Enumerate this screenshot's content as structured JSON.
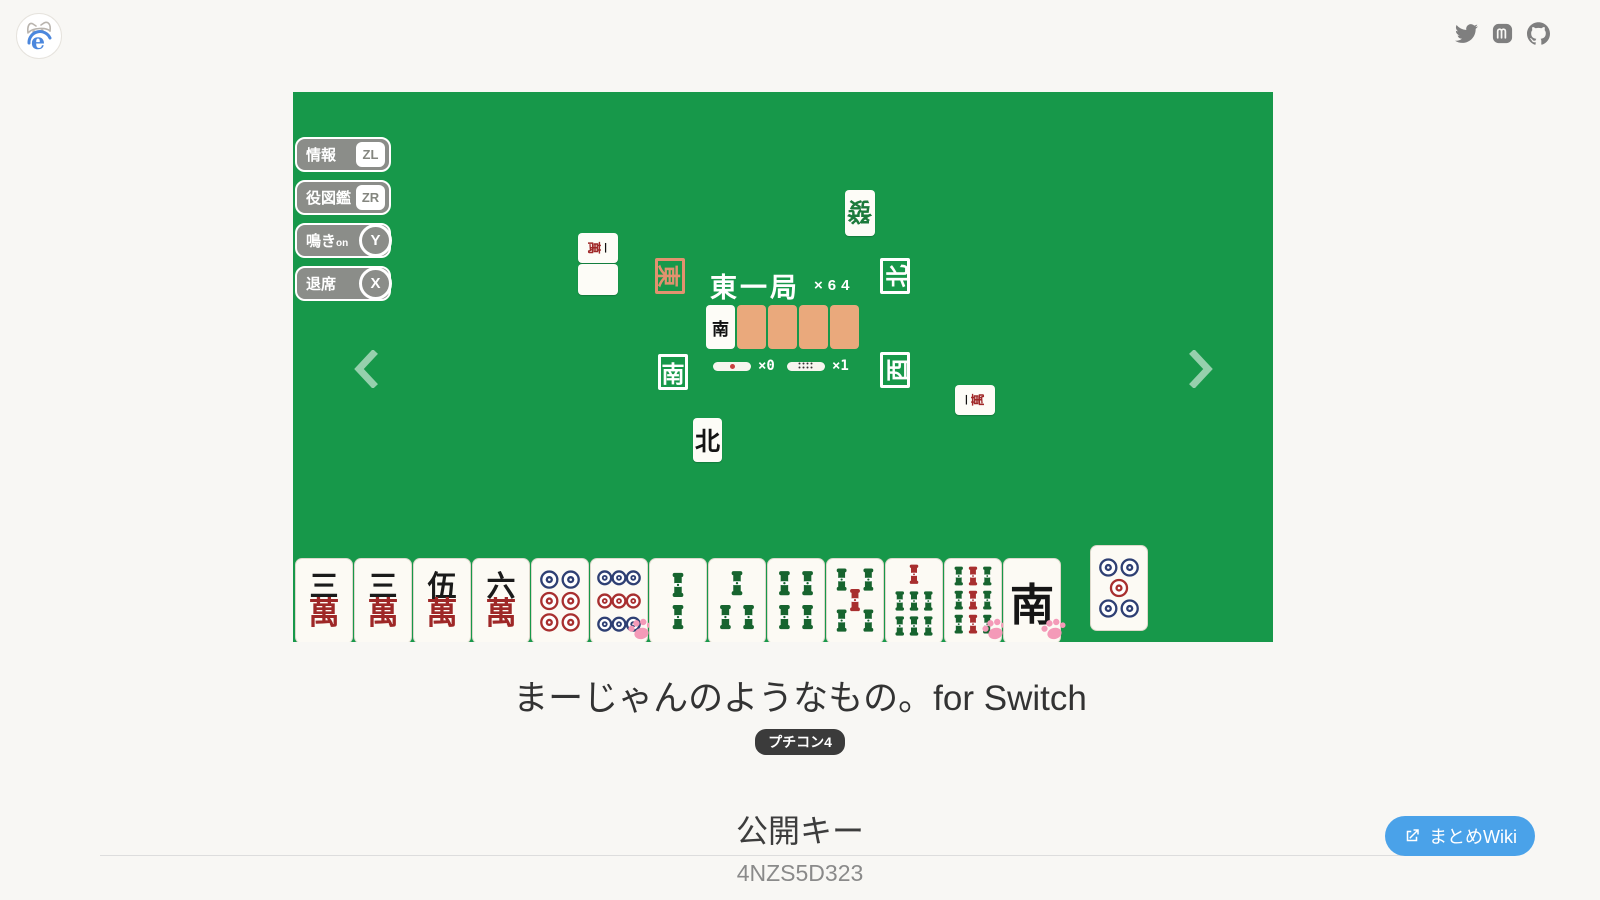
{
  "info": {
    "title": "まーじゃんのようなもの。for Switch",
    "badge": "プチコン4",
    "section_heading": "公開キー",
    "public_key": "4NZS5D323",
    "wiki_button": "まとめWiki"
  },
  "social": {
    "icons": [
      "twitter-icon",
      "mastodon-icon",
      "github-icon"
    ]
  },
  "carousel": {
    "icons": [
      "chevron-left-icon",
      "chevron-right-icon"
    ]
  },
  "colors": {
    "table_green": "#17984a",
    "tile_back_salmon": "#eaa97c",
    "east_highlight": "#e2926f",
    "wiki_blue": "#4aa2e9",
    "paw_pink": "#f49ab8"
  },
  "game": {
    "buttons": [
      {
        "label": "情報",
        "key": "ZL",
        "key_shape": "square"
      },
      {
        "label": "役図鑑",
        "key": "ZR",
        "key_shape": "square"
      },
      {
        "label": "鳴き",
        "suffix": "on",
        "key": "Y",
        "key_shape": "circle"
      },
      {
        "label": "退席",
        "key": "X",
        "key_shape": "circle"
      }
    ],
    "center": {
      "round_label": "東一局",
      "multiplier": "×64",
      "winds": [
        {
          "char": "東",
          "highlight": true
        },
        {
          "char": "南",
          "highlight": false
        },
        {
          "char": "北",
          "highlight": false
        },
        {
          "char": "西",
          "highlight": false
        }
      ],
      "dora_tile": "南",
      "hidden_dora_count": 4,
      "sticks": [
        {
          "type": "thousand-point-stick",
          "count": "×0"
        },
        {
          "type": "hundred-point-stick",
          "count": "×1"
        }
      ]
    },
    "discards": [
      {
        "glyph": "發",
        "kind": "green-dragon"
      },
      {
        "glyph": "一萬",
        "kind": "man-rotated"
      },
      {
        "glyph": "",
        "kind": "blank"
      },
      {
        "glyph": "北",
        "kind": "wind"
      },
      {
        "glyph": "一萬",
        "kind": "man-rotated"
      }
    ],
    "hand": [
      {
        "type": "man",
        "num": "三",
        "suffix": "萬"
      },
      {
        "type": "man",
        "num": "三",
        "suffix": "萬"
      },
      {
        "type": "man",
        "num": "伍",
        "suffix": "萬"
      },
      {
        "type": "man",
        "num": "六",
        "suffix": "萬"
      },
      {
        "type": "pin",
        "n": 6
      },
      {
        "type": "pin",
        "n": 9,
        "paw": true
      },
      {
        "type": "sou",
        "n": 2
      },
      {
        "type": "sou",
        "n": 3
      },
      {
        "type": "sou",
        "n": 4
      },
      {
        "type": "sou",
        "n": 5
      },
      {
        "type": "sou",
        "n": 7
      },
      {
        "type": "sou",
        "n": 9,
        "paw": true
      },
      {
        "type": "honor",
        "char": "南",
        "paw": true
      }
    ],
    "drawn_tile": {
      "type": "pin",
      "n": 5
    }
  }
}
